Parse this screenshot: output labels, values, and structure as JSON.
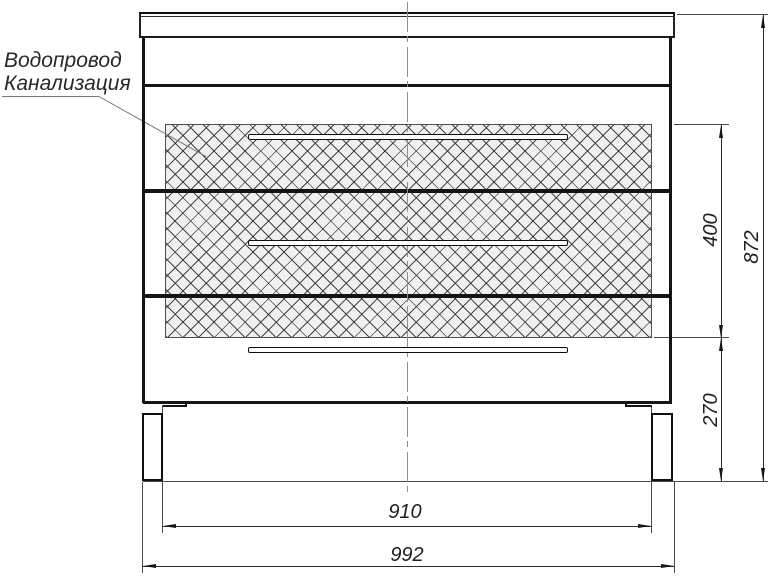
{
  "diagram": {
    "callout": {
      "line1": "Водопровод",
      "line2": "Канализация"
    },
    "dimensions": {
      "drawer_zone_height": "400",
      "overall_height": "872",
      "base_height": "270",
      "inner_width": "910",
      "overall_width": "992"
    },
    "colors": {
      "line": "#141414",
      "centerline": "#8d8d8d",
      "hatch_background": "#f0f0f0",
      "text": "#1f1f1f"
    }
  }
}
